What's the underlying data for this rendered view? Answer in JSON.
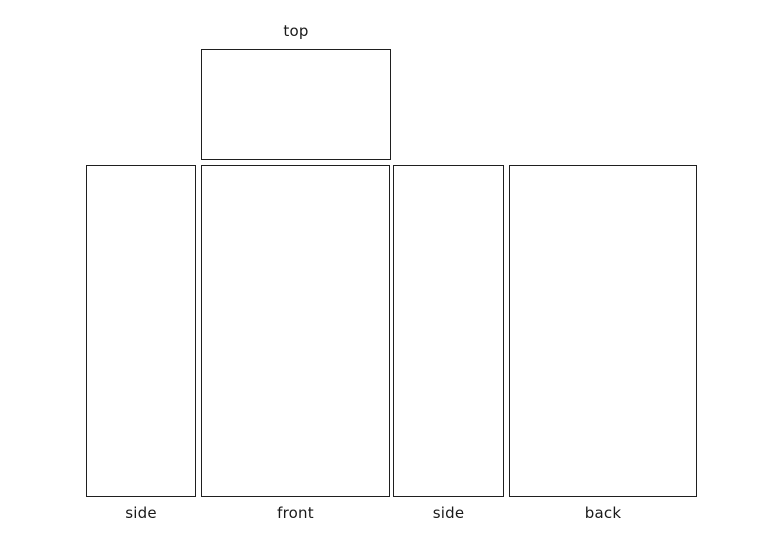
{
  "diagram": {
    "background_color": "#ffffff",
    "line_color": "#1f1f1f",
    "text_color": "#1a1a1a",
    "panels": [
      {
        "id": "top",
        "label": "top",
        "label_position": "above"
      },
      {
        "id": "side-left",
        "label": "side",
        "label_position": "below"
      },
      {
        "id": "front",
        "label": "front",
        "label_position": "below"
      },
      {
        "id": "side-right",
        "label": "side",
        "label_position": "below"
      },
      {
        "id": "back",
        "label": "back",
        "label_position": "below"
      }
    ]
  }
}
